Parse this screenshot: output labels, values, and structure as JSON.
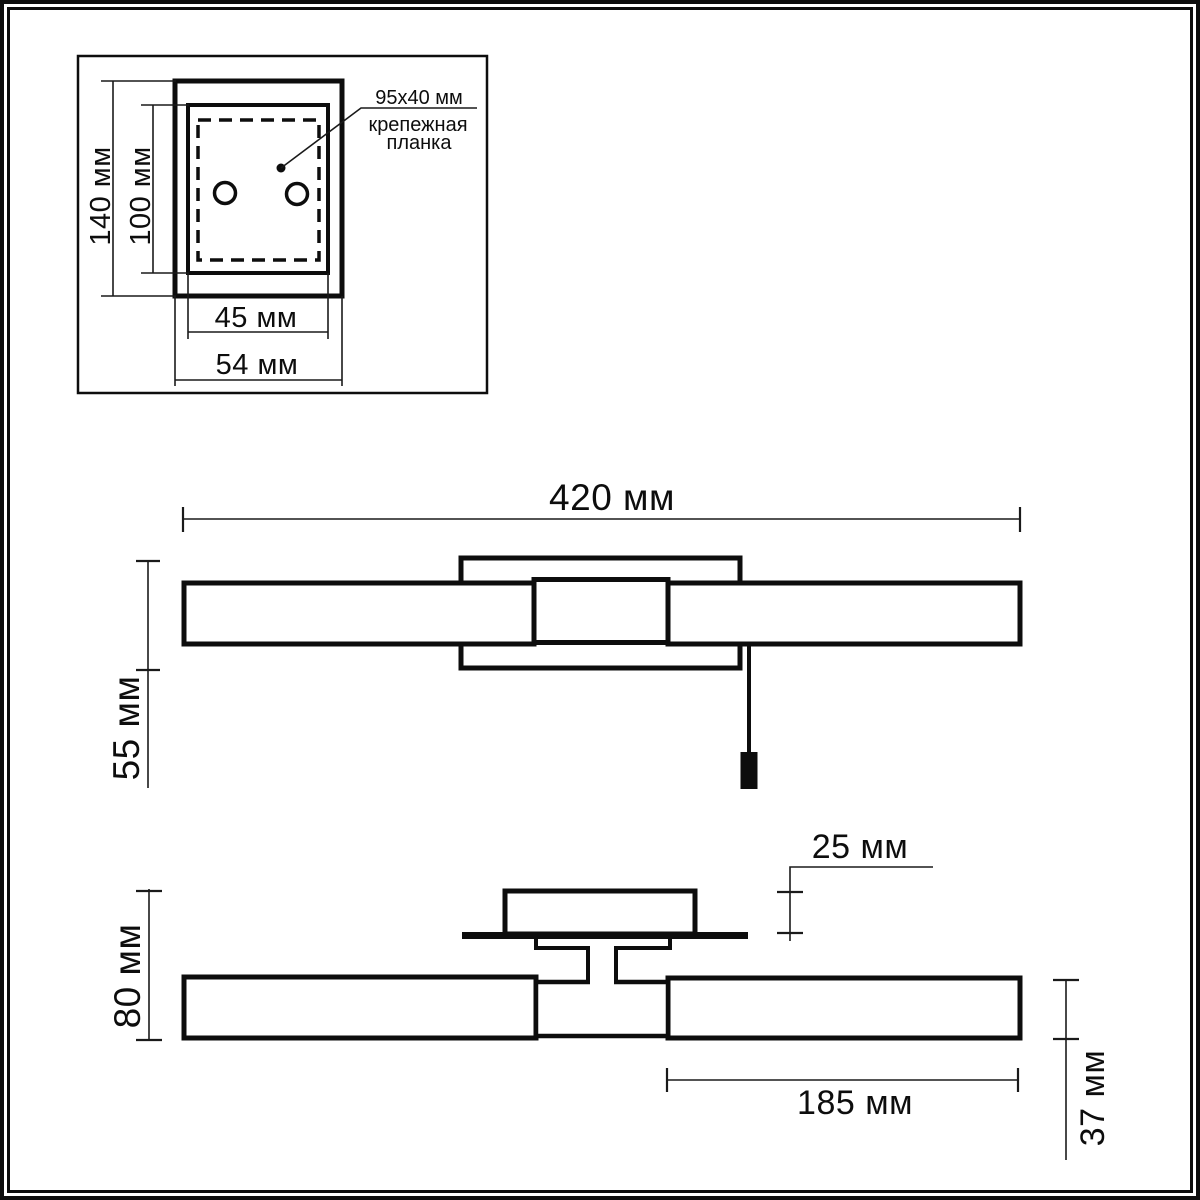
{
  "page": {
    "background": "#ffffff",
    "line_color": "#0d0d0d",
    "kind": "luminaire dimensional drawing"
  },
  "detail_view": {
    "dim_height_outer": "140 мм",
    "dim_height_inner": "100 мм",
    "dim_width_inner": "45 мм",
    "dim_width_outer": "54 мм",
    "callout_size": "95x40 мм",
    "callout_name_line1": "крепежная",
    "callout_name_line2": "планка"
  },
  "front_view": {
    "dim_width": "420 мм",
    "dim_height": "55 мм"
  },
  "top_view": {
    "dim_depth": "80 мм",
    "dim_plate_offset": "25 мм",
    "dim_shade_length": "185 мм",
    "dim_shade_diameter": "37 мм"
  }
}
